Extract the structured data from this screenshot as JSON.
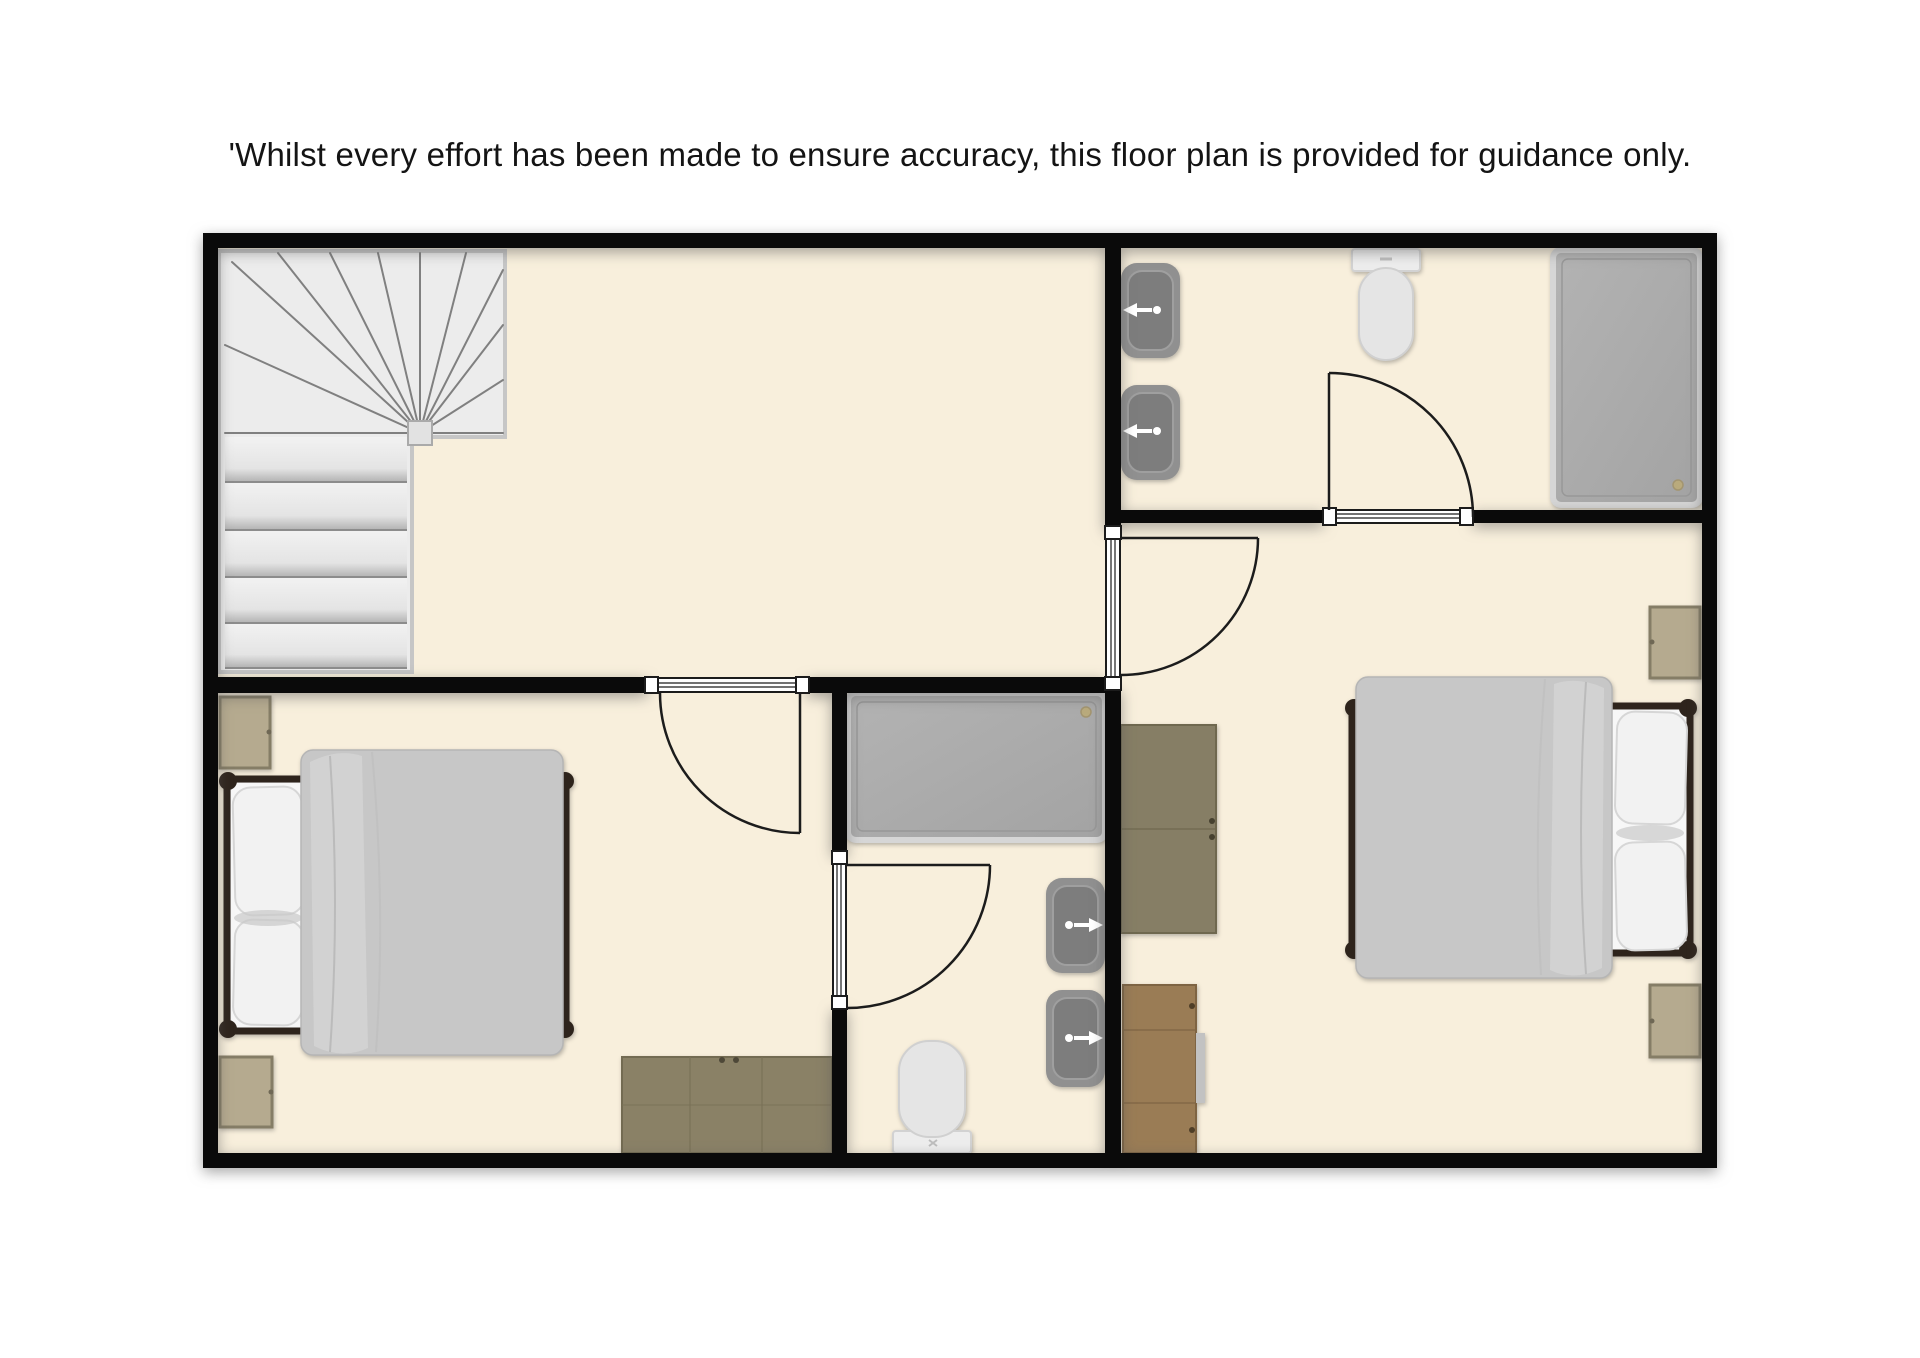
{
  "disclaimer": "'Whilst every effort has been made to ensure accuracy, this floor plan is provided for guidance only.",
  "palette": {
    "page_background": "#ffffff",
    "floor": "#f8efdc",
    "wall": "#0a0a0a",
    "staircase": "#ededed",
    "shower_tray": "#ababab",
    "sink": "#8f8f8f",
    "toilet": "#e9e9e9",
    "duvet": "#c7c7c7",
    "pillow": "#f2f2f2",
    "bed_frame": "#2e241c",
    "bedside_table": "#b5aa8f",
    "wood_grey": "#8a8166",
    "wood_warm": "#9a7c55"
  },
  "plan": {
    "rooms": [
      {
        "name": "landing",
        "fixtures": [
          "winder-staircase"
        ]
      },
      {
        "name": "bedroom-left",
        "fixtures": [
          "double-bed",
          "bedside-table",
          "bedside-table",
          "chest-of-drawers"
        ]
      },
      {
        "name": "ensuite-middle",
        "fixtures": [
          "shower-tray",
          "sink",
          "sink",
          "toilet"
        ]
      },
      {
        "name": "bedroom-right",
        "fixtures": [
          "double-bed",
          "bedside-table",
          "bedside-table",
          "wardrobe",
          "wardrobe"
        ]
      },
      {
        "name": "ensuite-top-right",
        "fixtures": [
          "sink",
          "sink",
          "toilet",
          "shower-tray"
        ]
      }
    ],
    "doors": [
      "left-bedroom-door",
      "right-bedroom-door",
      "top-bathroom-door",
      "middle-bathroom-door"
    ]
  }
}
